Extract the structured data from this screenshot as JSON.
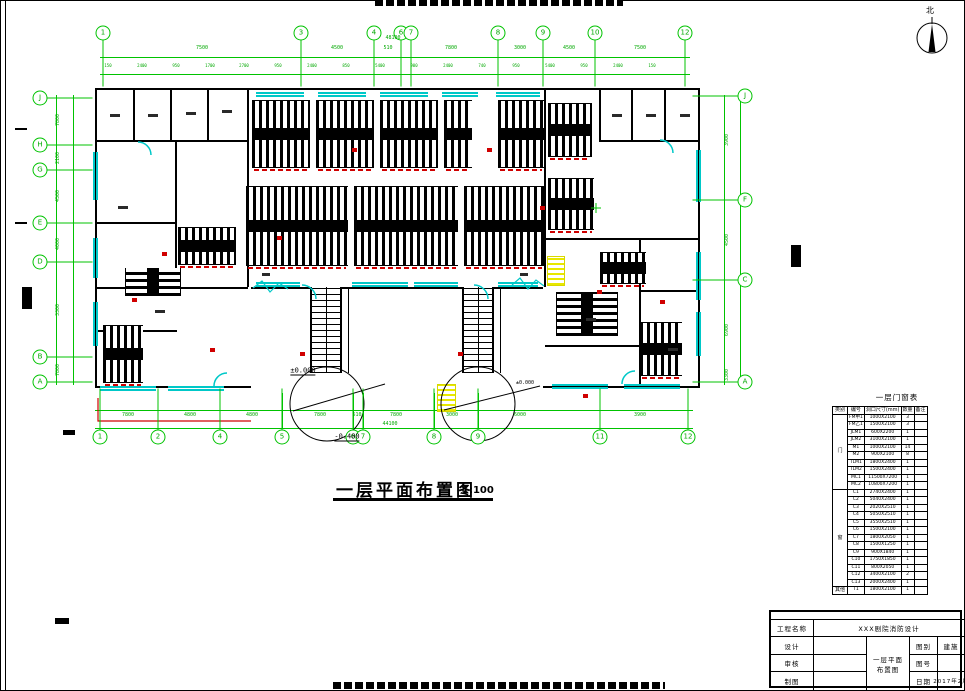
{
  "page": {
    "green": "#00c300",
    "cyan": "#00c8c8",
    "red": "#d00000",
    "yellow": "#e8e800",
    "top_strip": "cropped-text",
    "bottom_strip": "cropped-text"
  },
  "compass": {
    "label": "北"
  },
  "titles": {
    "main": "一层平面布置图",
    "scale": "1:100"
  },
  "elevations": {
    "zero": "±0.000",
    "neg": "-0.400"
  },
  "grid": {
    "top": [
      {
        "t": "1",
        "x": 103
      },
      {
        "t": "3",
        "x": 301
      },
      {
        "t": "4",
        "x": 374
      },
      {
        "t": "6",
        "x": 401
      },
      {
        "t": "7",
        "x": 411
      },
      {
        "t": "8",
        "x": 498
      },
      {
        "t": "9",
        "x": 543
      },
      {
        "t": "10",
        "x": 595
      },
      {
        "t": "12",
        "x": 685
      }
    ],
    "bottom": [
      {
        "t": "1",
        "x": 100
      },
      {
        "t": "2",
        "x": 158
      },
      {
        "t": "4",
        "x": 220
      },
      {
        "t": "5",
        "x": 282
      },
      {
        "t": "6",
        "x": 353
      },
      {
        "t": "7",
        "x": 363
      },
      {
        "t": "8",
        "x": 434
      },
      {
        "t": "9",
        "x": 478
      },
      {
        "t": "11",
        "x": 600
      },
      {
        "t": "12",
        "x": 688
      }
    ],
    "left": [
      {
        "t": "J",
        "y": 98
      },
      {
        "t": "H",
        "y": 145
      },
      {
        "t": "G",
        "y": 170
      },
      {
        "t": "E",
        "y": 223
      },
      {
        "t": "D",
        "y": 262
      },
      {
        "t": "B",
        "y": 357
      },
      {
        "t": "A",
        "y": 382
      }
    ],
    "right": [
      {
        "t": "J",
        "y": 96
      },
      {
        "t": "F",
        "y": 200
      },
      {
        "t": "C",
        "y": 280
      },
      {
        "t": "A",
        "y": 382
      }
    ]
  },
  "dims": {
    "top_row1": [
      {
        "t": "48100",
        "x": 393,
        "y": 38
      },
      {
        "t": "7500",
        "x": 202
      },
      {
        "t": "4500",
        "x": 337
      },
      {
        "t": "510",
        "x": 388
      },
      {
        "t": "7800",
        "x": 451
      },
      {
        "t": "3000",
        "x": 520
      },
      {
        "t": "4500",
        "x": 569
      },
      {
        "t": "7500",
        "x": 640
      }
    ],
    "top_row2": [
      {
        "t": "150",
        "x": 108
      },
      {
        "t": "2400",
        "x": 142
      },
      {
        "t": "950",
        "x": 176
      },
      {
        "t": "1700",
        "x": 210
      },
      {
        "t": "2700",
        "x": 244
      },
      {
        "t": "950",
        "x": 278
      },
      {
        "t": "2400",
        "x": 312
      },
      {
        "t": "850",
        "x": 346
      },
      {
        "t": "5400",
        "x": 380
      },
      {
        "t": "900",
        "x": 414
      },
      {
        "t": "2400",
        "x": 448
      },
      {
        "t": "740",
        "x": 482
      },
      {
        "t": "950",
        "x": 516
      },
      {
        "t": "5400",
        "x": 550
      },
      {
        "t": "950",
        "x": 584
      },
      {
        "t": "2400",
        "x": 618
      },
      {
        "t": "150",
        "x": 652
      }
    ],
    "bottom_row1": [
      {
        "t": "7800",
        "x": 128
      },
      {
        "t": "4800",
        "x": 190
      },
      {
        "t": "4800",
        "x": 252
      },
      {
        "t": "7800",
        "x": 320
      },
      {
        "t": "510",
        "x": 357
      },
      {
        "t": "7800",
        "x": 396
      },
      {
        "t": "3000",
        "x": 452
      },
      {
        "t": "6000",
        "x": 520
      },
      {
        "t": "3900",
        "x": 640
      },
      {
        "t": "44100",
        "x": 390,
        "y": 424
      }
    ],
    "left_col": [
      {
        "t": "7800",
        "y": 120
      },
      {
        "t": "2100",
        "y": 158
      },
      {
        "t": "4500",
        "y": 196
      },
      {
        "t": "4000",
        "y": 244
      },
      {
        "t": "3300",
        "y": 310
      },
      {
        "t": "7800",
        "y": 370
      }
    ],
    "right_col": [
      {
        "t": "3900",
        "y": 140
      },
      {
        "t": "4500",
        "y": 240
      },
      {
        "t": "6900",
        "y": 330
      },
      {
        "t": "3300",
        "y": 375
      }
    ]
  },
  "schedule": {
    "title": "一层门窗表",
    "headers": [
      "类别",
      "编号",
      "洞口尺寸(mm)",
      "数量",
      "备注"
    ],
    "groups": [
      {
        "category": "门",
        "rows": [
          [
            "FM甲1",
            "1000X2100",
            "3",
            ""
          ],
          [
            "FM乙1",
            "1500X2100",
            "3",
            ""
          ],
          [
            "JLM1",
            "600X2200",
            "1",
            ""
          ],
          [
            "JLM2",
            "3100X2100",
            "1",
            ""
          ],
          [
            "M1",
            "1000X2100",
            "14",
            ""
          ],
          [
            "M2",
            "900X2100",
            "8",
            ""
          ],
          [
            "TLM1",
            "1800X2400",
            "1",
            ""
          ],
          [
            "TLM2",
            "1500X2400",
            "1",
            ""
          ],
          [
            "MC1",
            "11500X7200",
            "1",
            ""
          ],
          [
            "MC2",
            "10800X7200",
            "1",
            ""
          ]
        ]
      },
      {
        "category": "窗",
        "rows": [
          [
            "C1",
            "2740X2400",
            "1",
            ""
          ],
          [
            "C2",
            "5040X2400",
            "1",
            ""
          ],
          [
            "C3",
            "2020X2510",
            "1",
            ""
          ],
          [
            "C4",
            "5050X2510",
            "1",
            ""
          ],
          [
            "C5",
            "3550X2510",
            "1",
            ""
          ],
          [
            "C6",
            "1500X2100",
            "1",
            ""
          ],
          [
            "C7",
            "1800X2050",
            "1",
            ""
          ],
          [
            "C8",
            "1500X1250",
            "1",
            ""
          ],
          [
            "C9",
            "900X1840",
            "1",
            ""
          ],
          [
            "C10",
            "1750X1850",
            "1",
            ""
          ],
          [
            "C11",
            "800X2050",
            "1",
            ""
          ],
          [
            "C12",
            "3400X2100",
            "2",
            ""
          ],
          [
            "C13",
            "2000X2400",
            "1",
            ""
          ]
        ]
      },
      {
        "category": "其他",
        "rows": [
          [
            "T1",
            "1800X2100",
            "1",
            ""
          ]
        ]
      }
    ]
  },
  "titleblock": {
    "project_label": "工程名称",
    "project_value": "XXX剧院消防设计",
    "staff": [
      {
        "label": "设计"
      },
      {
        "label": "审核"
      },
      {
        "label": "制图"
      }
    ],
    "drawing_line1": "一层平面",
    "drawing_line2": "布置图",
    "fields": [
      {
        "label": "图别",
        "value": "建施"
      },
      {
        "label": "图号",
        "value": ""
      },
      {
        "label": "日期",
        "value": "2017年2月"
      }
    ]
  }
}
